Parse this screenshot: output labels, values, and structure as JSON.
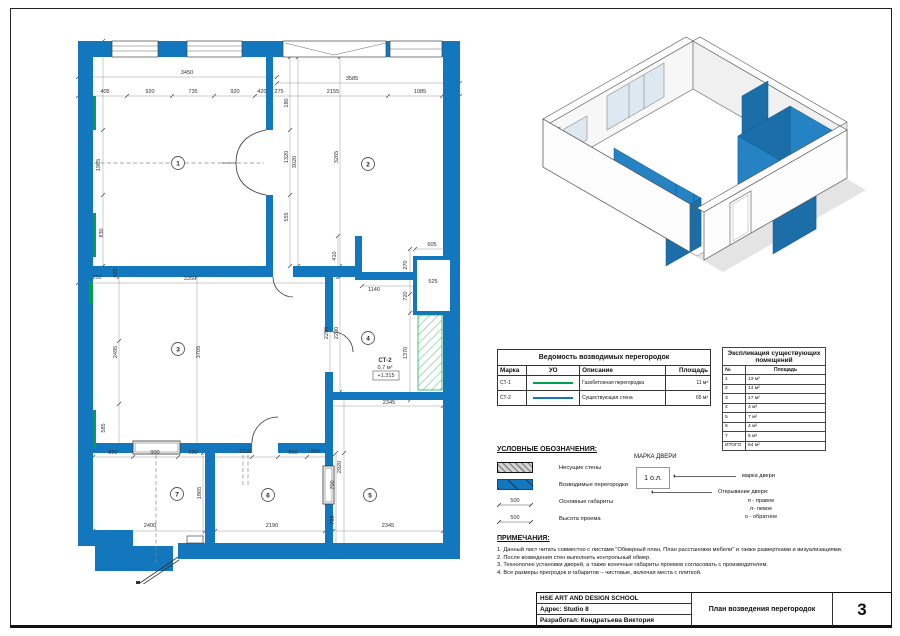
{
  "titleblock": {
    "org": "HSE ART AND DESIGN SCHOOL",
    "address": "Адрес:  Studio 8",
    "author": "Разработал: Кондратьева Виктория",
    "title": "План возведения перегородок",
    "sheet": "3"
  },
  "partitions_table": {
    "title": "Ведомость возводимых перегородок",
    "columns": [
      "Марка",
      "УО",
      "Описание",
      "Площадь"
    ],
    "rows": [
      {
        "mark": "СТ-1",
        "color": "#00A14B",
        "desc": "Газобетонная перегородка",
        "area": "11 м²"
      },
      {
        "mark": "СТ-2",
        "color": "#1377BD",
        "desc": "Существующая стена",
        "area": "65 м²"
      }
    ]
  },
  "rooms_table": {
    "title": "Экспликация существующих помещений",
    "columns": [
      "№",
      "Площадь"
    ],
    "rows": [
      [
        "1",
        "13 м²"
      ],
      [
        "2",
        "14 м²"
      ],
      [
        "3",
        "17 м²"
      ],
      [
        "4",
        "4 м²"
      ],
      [
        "5",
        "7 м²"
      ],
      [
        "6",
        "4 м²"
      ],
      [
        "7",
        "5 м²"
      ],
      [
        "ИТОГО",
        "64 м²"
      ]
    ]
  },
  "legend": {
    "title": "УСЛОВНЫЕ ОБОЗНАЧЕНИЯ:",
    "items": [
      {
        "label": "Несущие стены"
      },
      {
        "label": "Возводимые перегородки"
      },
      {
        "label": "Основные габариты",
        "value": "500"
      },
      {
        "label": "Высота проема",
        "value": "500"
      }
    ],
    "door_mark": {
      "title": "МАРКА ДВЕРИ",
      "tag": "1 о.л.",
      "leader1": "марка двери",
      "leader2": "Открывание двери:",
      "options": [
        "п - правое",
        "л- левое",
        "о - обратное"
      ]
    }
  },
  "notes": {
    "title": "ПРИМЕЧАНИЯ:",
    "items": [
      "1. Данный лист читать совместно с листами \"Обмерный план, План расстановки мебели\" и также развертками и визуализациями.",
      "2. После возведения стен выполнить контрольный обмер.",
      "3. Технологию установки дверей, а также конечные габариты проемов согласовать с производителем.",
      "4. Все размеры прегродок и габаритов – чистовые, включая места с плиткой."
    ]
  },
  "plan": {
    "wall_color": "#1377BD",
    "new_partition_color": "#00A14B",
    "rooms": [
      {
        "n": "1",
        "x": 106,
        "y": 127
      },
      {
        "n": "2",
        "x": 296,
        "y": 128
      },
      {
        "n": "3",
        "x": 106,
        "y": 313
      },
      {
        "n": "4",
        "x": 296,
        "y": 302
      },
      {
        "n": "5",
        "x": 298,
        "y": 459
      },
      {
        "n": "6",
        "x": 196,
        "y": 459
      },
      {
        "n": "7",
        "x": 105,
        "y": 458
      }
    ],
    "dims": [
      {
        "t": "3450",
        "x": 115,
        "y": 38
      },
      {
        "t": "405",
        "x": 33,
        "y": 57
      },
      {
        "t": "920",
        "x": 78,
        "y": 57
      },
      {
        "t": "735",
        "x": 121,
        "y": 57
      },
      {
        "t": "920",
        "x": 163,
        "y": 57
      },
      {
        "t": "420",
        "x": 190,
        "y": 57
      },
      {
        "t": "275",
        "x": 207,
        "y": 57
      },
      {
        "t": "3585",
        "x": 280,
        "y": 44
      },
      {
        "t": "2155",
        "x": 261,
        "y": 57
      },
      {
        "t": "1085",
        "x": 348,
        "y": 57
      },
      {
        "t": "3350",
        "x": 118,
        "y": 244
      },
      {
        "t": "250",
        "x": 25,
        "y": 243
      },
      {
        "t": "1140",
        "x": 302,
        "y": 255
      },
      {
        "t": "605",
        "x": 360,
        "y": 210
      },
      {
        "t": "525",
        "x": 361,
        "y": 247
      },
      {
        "t": "2345",
        "x": 317,
        "y": 368
      },
      {
        "t": "850",
        "x": 41,
        "y": 418
      },
      {
        "t": "900",
        "x": 83,
        "y": 418
      },
      {
        "t": "650",
        "x": 121,
        "y": 418
      },
      {
        "t": "1225",
        "x": 173,
        "y": 417
      },
      {
        "t": "650",
        "x": 221,
        "y": 418
      },
      {
        "t": "365",
        "x": 243,
        "y": 417
      },
      {
        "t": "2400",
        "x": 78,
        "y": 491
      },
      {
        "t": "2190",
        "x": 200,
        "y": 491
      },
      {
        "t": "2345",
        "x": 316,
        "y": 491
      },
      {
        "t": "1985",
        "x": 28,
        "y": 129,
        "v": 1
      },
      {
        "t": "830",
        "x": 31,
        "y": 197,
        "v": 1
      },
      {
        "t": "625",
        "x": 45,
        "y": 237,
        "v": 1
      },
      {
        "t": "2495",
        "x": 45,
        "y": 316,
        "v": 1
      },
      {
        "t": "3705",
        "x": 128,
        "y": 316,
        "v": 1
      },
      {
        "t": "585",
        "x": 33,
        "y": 392,
        "v": 1
      },
      {
        "t": "180",
        "x": 216,
        "y": 67,
        "v": 1
      },
      {
        "t": "1320",
        "x": 216,
        "y": 121,
        "v": 1
      },
      {
        "t": "3020",
        "x": 224,
        "y": 126,
        "v": 1
      },
      {
        "t": "3265",
        "x": 266,
        "y": 121,
        "v": 1
      },
      {
        "t": "555",
        "x": 216,
        "y": 181,
        "v": 1
      },
      {
        "t": "410",
        "x": 264,
        "y": 220,
        "v": 1
      },
      {
        "t": "270",
        "x": 335,
        "y": 229,
        "v": 1
      },
      {
        "t": "720",
        "x": 335,
        "y": 260,
        "v": 1
      },
      {
        "t": "2290",
        "x": 256,
        "y": 297,
        "v": 1
      },
      {
        "t": "2290",
        "x": 266,
        "y": 297,
        "v": 1
      },
      {
        "t": "1370",
        "x": 335,
        "y": 317,
        "v": 1
      },
      {
        "t": "1865",
        "x": 129,
        "y": 457,
        "v": 1
      },
      {
        "t": "2920",
        "x": 269,
        "y": 431,
        "v": 1
      },
      {
        "t": "700",
        "x": 262,
        "y": 449,
        "v": 1
      },
      {
        "t": "785",
        "x": 262,
        "y": 484,
        "v": 1
      }
    ],
    "annotations": [
      {
        "t": "СТ-2",
        "x": 313,
        "y": 326,
        "b": 1
      },
      {
        "t": "0.7 м²",
        "x": 313,
        "y": 333
      },
      {
        "t": "+1.315",
        "x": 314,
        "y": 341
      }
    ]
  }
}
